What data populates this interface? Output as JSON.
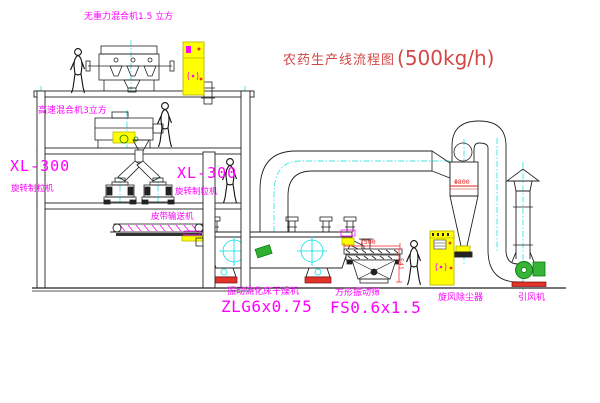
{
  "title": {
    "name": "农药生产线流程图",
    "capacity": "(500kg/h)"
  },
  "labels": {
    "no_gravity_mixer": "无重力混合机1.5 立方",
    "high_speed_mixer": "高速混合机3立方",
    "mill_left_model": "XL-300",
    "mill_left_name": "旋转制粒机",
    "mill_mid_model": "XL-300",
    "mill_mid_name": "旋转制粒机",
    "belt_conveyor": "皮带输送机",
    "dryer_name": "振动流化床干燥机",
    "dryer_model": "ZLG6x0.75",
    "sieve_name": "方形振动筛",
    "sieve_model": "FS0.6x1.5",
    "cyclone_name": "旋风除尘器",
    "fan_name": "引风机"
  },
  "dimensions": {
    "sieve_length": "1500",
    "sieve_height": "541",
    "cyclone_diameter": "Φ800"
  },
  "colors": {
    "label_magenta": "#ff00ff",
    "title_red": "#d24848",
    "centerline_cyan": "#00e0e0",
    "cabinet_yellow": "#ffff00",
    "accent_green": "#2fae2f",
    "accent_red": "#e23328",
    "line_black": "#222222"
  }
}
